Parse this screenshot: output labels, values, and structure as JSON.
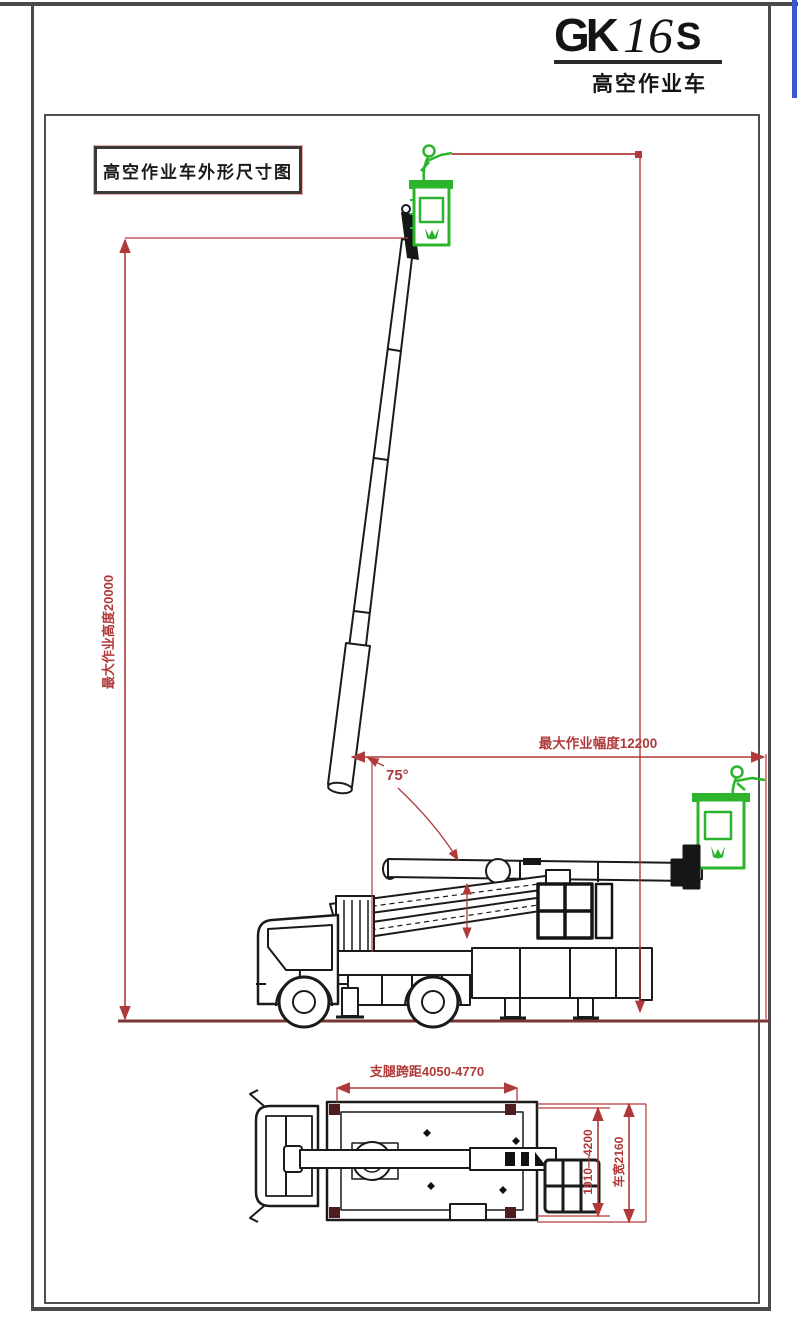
{
  "title_block": {
    "model_gk": "GK",
    "model_16": "16",
    "model_s": "S",
    "subtitle": "高空作业车"
  },
  "drawing": {
    "caption": "高空作业车外形尺寸图",
    "side_view": {
      "dim_max_height": "最大作业高度20000",
      "dim_max_radius": "最大作业幅度12200",
      "boom_angle": "75°"
    },
    "plan_view": {
      "dim_outrigger_span": "支腿跨距4050-4770",
      "dim_outrigger_width": "1910—4200",
      "dim_vehicle_width": "车宽2160"
    },
    "colors": {
      "dimension_red": "#b03a3a",
      "linework_black": "#1a1a1a",
      "basket_green": "#2cb52c",
      "ground_maroon": "#7a3535",
      "accent_blue": "#3a57d0"
    }
  }
}
